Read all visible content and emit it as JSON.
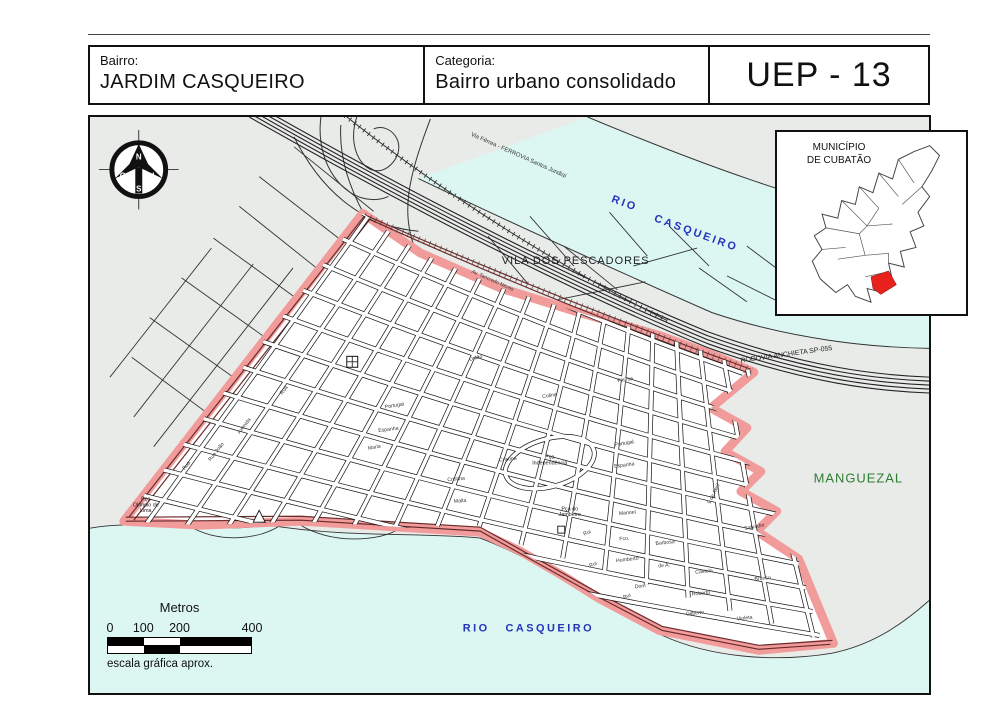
{
  "header": {
    "bairro_label": "Bairro:",
    "bairro_value": "JARDIM CASQUEIRO",
    "categoria_label": "Categoria:",
    "categoria_value": "Bairro urbano consolidado",
    "uep_code": "UEP - 13"
  },
  "map": {
    "rivers": {
      "top": [
        "RIO",
        "CASQUEIRO"
      ],
      "bottom": [
        "RIO",
        "CASQUEIRO"
      ]
    },
    "areas": {
      "vila": "VILA DOS PESCADORES",
      "manguezal": "MANGUEZAL"
    },
    "roads": {
      "rodovia": "RODOVIA ANCHIETA SP-055",
      "ferrovia": "Via Férrea - FERROVIA Santos Jundiaí"
    },
    "compass": {
      "n": "N",
      "s": "S",
      "o": "O",
      "l": "L"
    },
    "inset": {
      "title": [
        "MUNICÍPIO",
        "DE CUBATÃO"
      ],
      "highlight_color": "#e8211d"
    },
    "scalebar": {
      "title": "Metros",
      "ticks": [
        "0",
        "100",
        "200",
        "400"
      ],
      "caption": "escala gráfica aprox."
    },
    "street_labels": [
      {
        "t": "Av. Tancredo Neves",
        "x": 404,
        "y": 166,
        "r": 24
      },
      {
        "t": "União",
        "x": 388,
        "y": 244,
        "r": -14
      },
      {
        "t": "Portugal",
        "x": 306,
        "y": 292,
        "r": -9
      },
      {
        "t": "Espanha",
        "x": 300,
        "y": 316,
        "r": -7
      },
      {
        "t": "Maria",
        "x": 286,
        "y": 334,
        "r": -11
      },
      {
        "t": "Portugal",
        "x": 537,
        "y": 330,
        "r": -9
      },
      {
        "t": "Espanha",
        "x": 537,
        "y": 352,
        "r": -7
      },
      {
        "t": "Fátima",
        "x": 538,
        "y": 266,
        "r": -9
      },
      {
        "t": "Colina",
        "x": 462,
        "y": 282,
        "r": -9
      },
      {
        "t": "Cristina",
        "x": 420,
        "y": 346,
        "r": -6
      },
      {
        "t": "Cristina",
        "x": 368,
        "y": 366,
        "r": -5
      },
      {
        "t": "Malta",
        "x": 372,
        "y": 388,
        "r": -4
      },
      {
        "t": "Rua João",
        "x": 128,
        "y": 338,
        "r": -52
      },
      {
        "t": "Avenida",
        "x": 156,
        "y": 312,
        "r": -52
      },
      {
        "t": "Rua",
        "x": 98,
        "y": 352,
        "r": -52
      },
      {
        "t": "Rua",
        "x": 196,
        "y": 276,
        "r": -52
      },
      {
        "t": "9 de Abril",
        "x": 628,
        "y": 380,
        "r": -64
      },
      {
        "t": "Manoel",
        "x": 540,
        "y": 400,
        "r": -5
      },
      {
        "t": "Salvador",
        "x": 668,
        "y": 414,
        "r": -10
      },
      {
        "t": "Rui",
        "x": 500,
        "y": 420,
        "r": -22
      },
      {
        "t": "Fco.",
        "x": 537,
        "y": 426,
        "r": -6
      },
      {
        "t": "Barbosa",
        "x": 578,
        "y": 430,
        "r": -6
      },
      {
        "t": "Rui",
        "x": 506,
        "y": 452,
        "r": -22
      },
      {
        "t": "Humberto",
        "x": 540,
        "y": 447,
        "r": -6
      },
      {
        "t": "de A.",
        "x": 577,
        "y": 453,
        "r": -6
      },
      {
        "t": "Castelo",
        "x": 617,
        "y": 459,
        "r": -6
      },
      {
        "t": "Branco",
        "x": 676,
        "y": 466,
        "r": -6
      },
      {
        "t": "Dom",
        "x": 553,
        "y": 474,
        "r": -6
      },
      {
        "t": "Roberto",
        "x": 614,
        "y": 481,
        "r": -6
      },
      {
        "t": "Rui",
        "x": 540,
        "y": 484,
        "r": -22
      },
      {
        "t": "Gilberto",
        "x": 608,
        "y": 501,
        "r": -6
      },
      {
        "t": "Violeta",
        "x": 658,
        "y": 506,
        "r": -6
      }
    ],
    "place_labels": [
      {
        "lines": [
          "Pça",
          "Olímpio de",
          "Lima"
        ],
        "x": 56,
        "y": 386
      },
      {
        "lines": [
          "Pça",
          "Independência"
        ],
        "x": 462,
        "y": 344
      },
      {
        "lines": [
          "Pça do",
          "Jambeiro"
        ],
        "x": 482,
        "y": 396
      }
    ]
  },
  "colors": {
    "land": "#E8EBE8",
    "river": "#DCF7F2",
    "boundary_pink": "#F29B9B",
    "river_text_blue": "#2433BB",
    "manguezal_green": "#2e7d32",
    "inset_red": "#e8211d"
  }
}
